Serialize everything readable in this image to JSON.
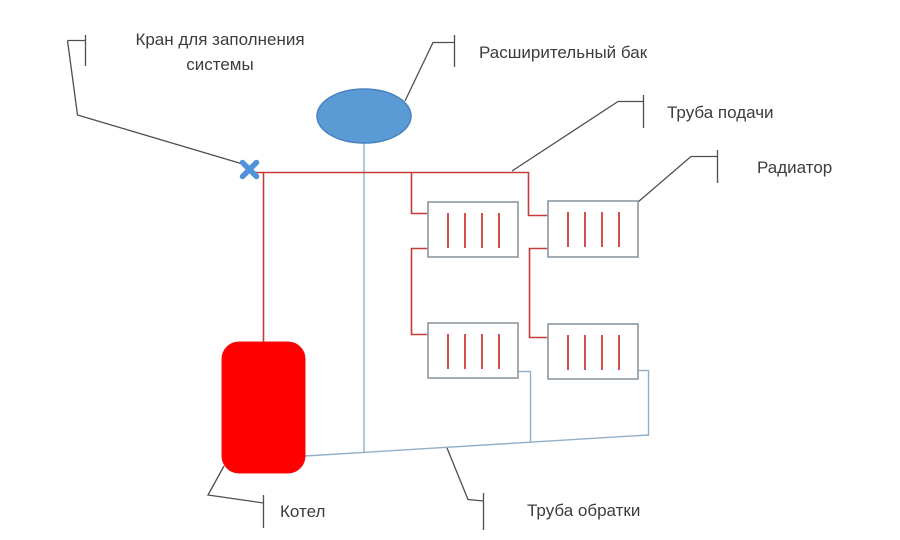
{
  "diagram": {
    "labels": {
      "fill_valve": "Кран для заполнения\nсистемы",
      "expansion_tank": "Расширительный бак",
      "supply_pipe": "Труба подачи",
      "radiator": "Радиатор",
      "boiler": "Котел",
      "return_pipe": "Труба обратки"
    },
    "colors": {
      "supply_pipe": "#c43c3c",
      "return_pipe": "#93afc7",
      "boiler_fill": "#fe0000",
      "boiler_stroke": "#ee1111",
      "tank_fill": "#5b9bd5",
      "tank_stroke": "#4a84c0",
      "valve": "#4f93d8",
      "radiator_stroke": "#9aa3ab",
      "radiator_fin": "#cf3a3a",
      "callout": "#4f4f4f",
      "text": "#3c3c3c",
      "background": "#ffffff"
    }
  }
}
